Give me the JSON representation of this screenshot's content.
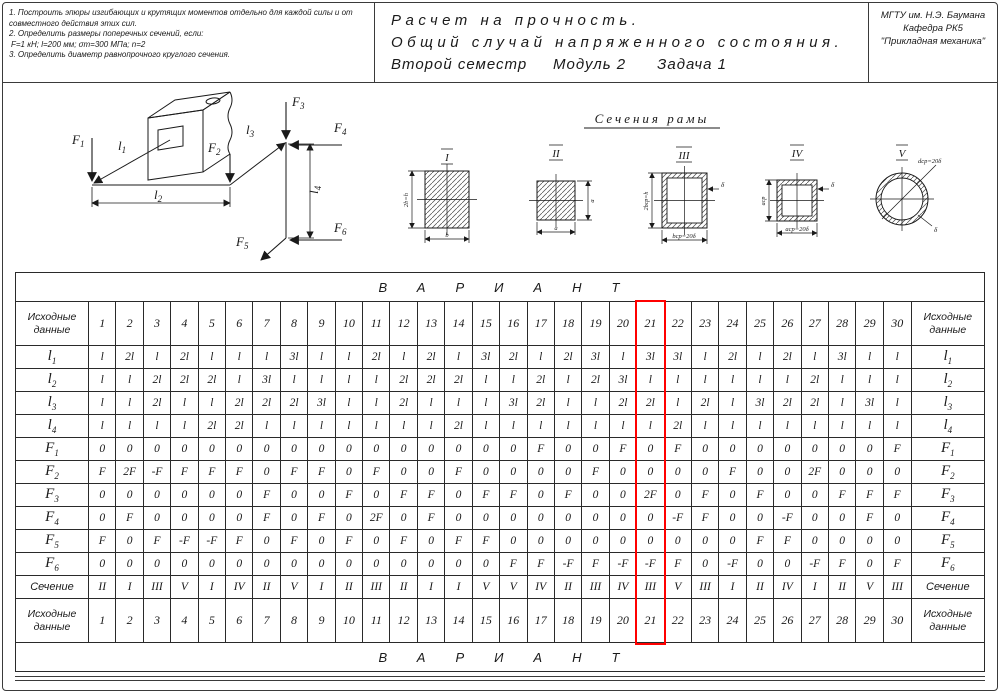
{
  "header": {
    "tasks": [
      "1.  Построить эпюры изгибающих и крутящих моментов отдельно для каждой силы и от совместного действия этих сил.",
      "2.  Определить размеры поперечных сечений, если:",
      "F=1 кН;  l=200 мм;  σт=300 МПа;  n=2",
      "3.  Определить диаметр равнопрочного круглого сечения."
    ],
    "title_line1": "Расчет на прочность.",
    "title_line2": "Общий случай напряженного состояния.",
    "title_line3": "Второй семестр     Модуль 2      Задача 1",
    "org_line1": "МГТУ им. Н.Э. Баумана",
    "org_line2": "Кафедра РК5",
    "org_line3": "\"Прикладная механика\""
  },
  "frame": {
    "lengths": [
      {
        "base": "l",
        "sub": "1"
      },
      {
        "base": "l",
        "sub": "2"
      },
      {
        "base": "l",
        "sub": "3"
      },
      {
        "base": "l",
        "sub": "4"
      }
    ],
    "forces": [
      {
        "base": "F",
        "sub": "1"
      },
      {
        "base": "F",
        "sub": "2"
      },
      {
        "base": "F",
        "sub": "3"
      },
      {
        "base": "F",
        "sub": "4"
      },
      {
        "base": "F",
        "sub": "5"
      },
      {
        "base": "F",
        "sub": "6"
      }
    ]
  },
  "sections": {
    "title": "Сечения рамы",
    "items": [
      {
        "numeral": "I",
        "dims": [
          "2b=h",
          "b"
        ]
      },
      {
        "numeral": "II",
        "dims": [
          "a",
          "a"
        ]
      },
      {
        "numeral": "III",
        "dims": [
          "2bср=h",
          "bср=20δ",
          "δ"
        ]
      },
      {
        "numeral": "IV",
        "dims": [
          "aср",
          "aср=20δ",
          "δ"
        ]
      },
      {
        "numeral": "V",
        "dims": [
          "dср=20δ",
          "δ"
        ]
      }
    ]
  },
  "table": {
    "variant_header": "ВАРИАНТ",
    "corner_label": "Исходные данные",
    "highlight_column": 21,
    "columns": [
      "1",
      "2",
      "3",
      "4",
      "5",
      "6",
      "7",
      "8",
      "9",
      "10",
      "11",
      "12",
      "13",
      "14",
      "15",
      "16",
      "17",
      "18",
      "19",
      "20",
      "21",
      "22",
      "23",
      "24",
      "25",
      "26",
      "27",
      "28",
      "29",
      "30"
    ],
    "rows": [
      {
        "base": "l",
        "sub": "1",
        "values": [
          "l",
          "2l",
          "l",
          "2l",
          "l",
          "l",
          "l",
          "3l",
          "l",
          "l",
          "2l",
          "l",
          "2l",
          "l",
          "3l",
          "2l",
          "l",
          "2l",
          "3l",
          "l",
          "3l",
          "3l",
          "l",
          "2l",
          "l",
          "2l",
          "l",
          "3l",
          "l",
          "l"
        ]
      },
      {
        "base": "l",
        "sub": "2",
        "values": [
          "l",
          "l",
          "2l",
          "2l",
          "2l",
          "l",
          "3l",
          "l",
          "l",
          "l",
          "l",
          "2l",
          "2l",
          "2l",
          "l",
          "l",
          "2l",
          "l",
          "2l",
          "3l",
          "l",
          "l",
          "l",
          "l",
          "l",
          "l",
          "2l",
          "l",
          "l",
          "l"
        ]
      },
      {
        "base": "l",
        "sub": "3",
        "values": [
          "l",
          "l",
          "2l",
          "l",
          "l",
          "2l",
          "2l",
          "2l",
          "3l",
          "l",
          "l",
          "2l",
          "l",
          "l",
          "l",
          "3l",
          "2l",
          "l",
          "l",
          "2l",
          "2l",
          "l",
          "2l",
          "l",
          "3l",
          "2l",
          "2l",
          "l",
          "3l",
          "l"
        ]
      },
      {
        "base": "l",
        "sub": "4",
        "values": [
          "l",
          "l",
          "l",
          "l",
          "2l",
          "2l",
          "l",
          "l",
          "l",
          "l",
          "l",
          "l",
          "l",
          "2l",
          "l",
          "l",
          "l",
          "l",
          "l",
          "l",
          "l",
          "2l",
          "l",
          "l",
          "l",
          "l",
          "l",
          "l",
          "l",
          "l"
        ]
      },
      {
        "base": "F",
        "sub": "1",
        "values": [
          "0",
          "0",
          "0",
          "0",
          "0",
          "0",
          "0",
          "0",
          "0",
          "0",
          "0",
          "0",
          "0",
          "0",
          "0",
          "0",
          "F",
          "0",
          "0",
          "F",
          "0",
          "F",
          "0",
          "0",
          "0",
          "0",
          "0",
          "0",
          "0",
          "F"
        ]
      },
      {
        "base": "F",
        "sub": "2",
        "values": [
          "F",
          "2F",
          "-F",
          "F",
          "F",
          "F",
          "0",
          "F",
          "F",
          "0",
          "F",
          "0",
          "0",
          "F",
          "0",
          "0",
          "0",
          "0",
          "F",
          "0",
          "0",
          "0",
          "0",
          "F",
          "0",
          "0",
          "2F",
          "0",
          "0",
          "0"
        ]
      },
      {
        "base": "F",
        "sub": "3",
        "values": [
          "0",
          "0",
          "0",
          "0",
          "0",
          "0",
          "F",
          "0",
          "0",
          "F",
          "0",
          "F",
          "F",
          "0",
          "F",
          "F",
          "0",
          "F",
          "0",
          "0",
          "2F",
          "0",
          "F",
          "0",
          "F",
          "0",
          "0",
          "F",
          "F",
          "F"
        ]
      },
      {
        "base": "F",
        "sub": "4",
        "values": [
          "0",
          "F",
          "0",
          "0",
          "0",
          "0",
          "F",
          "0",
          "F",
          "0",
          "2F",
          "0",
          "F",
          "0",
          "0",
          "0",
          "0",
          "0",
          "0",
          "0",
          "0",
          "-F",
          "F",
          "0",
          "0",
          "-F",
          "0",
          "0",
          "F",
          "0"
        ]
      },
      {
        "base": "F",
        "sub": "5",
        "values": [
          "F",
          "0",
          "F",
          "-F",
          "-F",
          "F",
          "0",
          "F",
          "0",
          "F",
          "0",
          "F",
          "0",
          "F",
          "F",
          "0",
          "0",
          "0",
          "0",
          "0",
          "0",
          "0",
          "0",
          "0",
          "F",
          "F",
          "0",
          "0",
          "0",
          "0"
        ]
      },
      {
        "base": "F",
        "sub": "6",
        "values": [
          "0",
          "0",
          "0",
          "0",
          "0",
          "0",
          "0",
          "0",
          "0",
          "0",
          "0",
          "0",
          "0",
          "0",
          "0",
          "F",
          "F",
          "-F",
          "F",
          "-F",
          "-F",
          "F",
          "0",
          "-F",
          "0",
          "0",
          "-F",
          "F",
          "0",
          "F"
        ]
      },
      {
        "base": "Сечение",
        "sub": "",
        "values": [
          "II",
          "I",
          "III",
          "V",
          "I",
          "IV",
          "II",
          "V",
          "I",
          "II",
          "III",
          "II",
          "I",
          "I",
          "V",
          "V",
          "IV",
          "II",
          "III",
          "IV",
          "III",
          "V",
          "III",
          "I",
          "II",
          "IV",
          "I",
          "II",
          "V",
          "III"
        ]
      }
    ]
  }
}
